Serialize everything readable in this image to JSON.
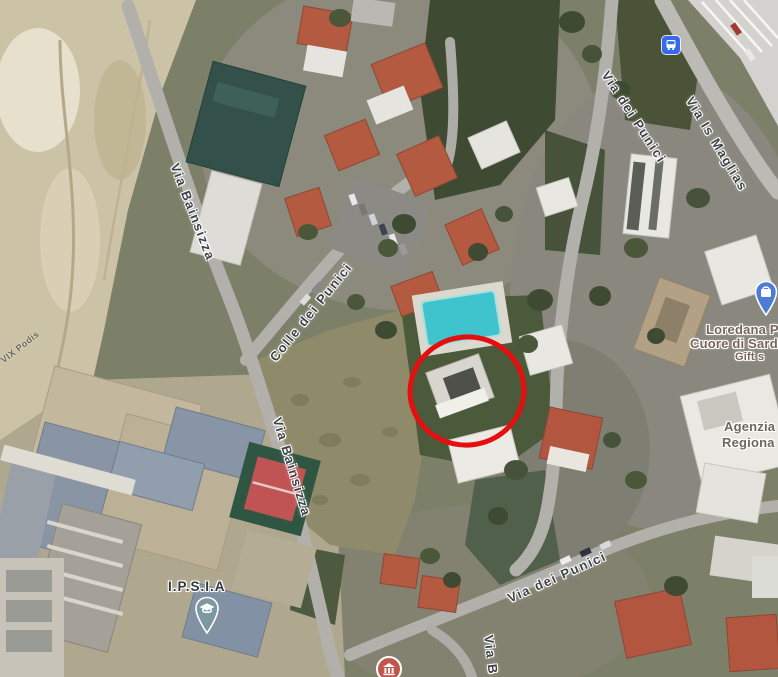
{
  "map": {
    "view_type": "satellite",
    "street_labels": [
      {
        "id": "via-bainsizza-upper",
        "text": "Via Bainsizza"
      },
      {
        "id": "via-bainsizza-lower",
        "text": "Via Bainsizza"
      },
      {
        "id": "colle-dei-punici",
        "text": "Colle dei Punici"
      },
      {
        "id": "via-dei-punici-upper",
        "text": "Via dei Punici"
      },
      {
        "id": "via-is-maglias",
        "text": "Via Is Maglias"
      },
      {
        "id": "via-dei-punici-lower",
        "text": "Via dei Punici"
      },
      {
        "id": "via-b-partial",
        "text": "Via B"
      },
      {
        "id": "path-label-faint",
        "text": "VIX Podis"
      }
    ],
    "place_labels": {
      "school": {
        "text": "I.P.S.I.A"
      },
      "gift_shop": {
        "line1": "Loredana Pod",
        "line2": "Cuore di Sardeg",
        "line3": "Gift s"
      },
      "agency": {
        "line1": "Agenzia",
        "line2": "Regiona"
      }
    },
    "icons": {
      "bus_stop": "bus-stop",
      "school_pin": "school-graduation-pin",
      "gift_pin": "shopping-gift-pin",
      "poi_bottom": "temple-poi"
    },
    "annotation": {
      "shape": "hand-drawn-circle",
      "color": "#e60f0f"
    },
    "colors": {
      "annotation_red": "#e60f0f",
      "bus_icon_blue": "#3569ee",
      "gift_pin_blue": "#4d7bd6",
      "school_pin_teal": "#7b98a3",
      "poi_red": "#c0564c",
      "pool_teal": "#3fc3cc",
      "roof_terracotta": "#b35a41",
      "rock_tan": "#ccc3a6"
    }
  }
}
